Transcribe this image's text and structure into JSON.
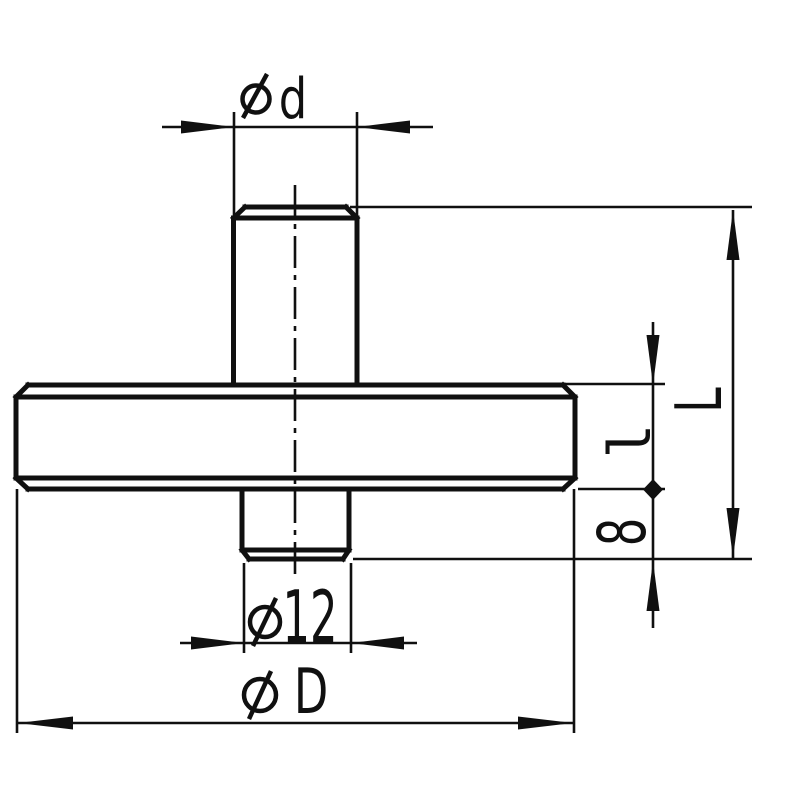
{
  "page": {
    "background": "#ffffff",
    "ink": "#101010"
  },
  "drawing": {
    "type": "technical-part-side-view",
    "part": "disc measuring tip with top stem, wide chamfered disc and threaded bottom stub",
    "labels": {
      "dim_d": {
        "symbol": "ø",
        "value": "d"
      },
      "dim_12": {
        "symbol": "ø",
        "value": "12"
      },
      "dim_D": {
        "symbol": "ø",
        "value": "D"
      },
      "dim_L": {
        "value": "L"
      },
      "dim_l": {
        "value": "l"
      },
      "dim_8": {
        "value": "8"
      }
    }
  }
}
